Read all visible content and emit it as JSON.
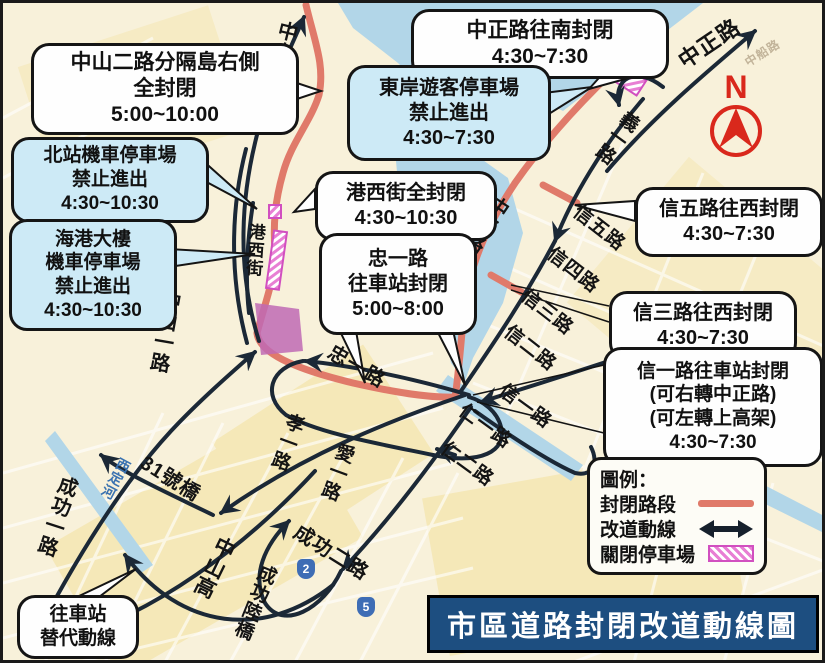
{
  "title_banner": "市區道路封閉改道動線圖",
  "compass": {
    "label": "N"
  },
  "legend": {
    "title": "圖例：",
    "items": [
      {
        "label": "封閉路段",
        "symbol": "closed-road-line"
      },
      {
        "label": "改道動線",
        "symbol": "detour-double-arrow"
      },
      {
        "label": "關閉停車場",
        "symbol": "closed-parking-hatch"
      }
    ]
  },
  "callouts": [
    {
      "id": "zhongshan2-closure",
      "style": "white",
      "lines": [
        "中山二路分隔島右側",
        "全封閉",
        "5:00~10:00"
      ]
    },
    {
      "id": "north-station-parking",
      "style": "blue",
      "lines": [
        "北站機車停車場",
        "禁止進出",
        "4:30~10:30"
      ]
    },
    {
      "id": "harbor-building-parking",
      "style": "blue",
      "lines": [
        "海港大樓",
        "機車停車場",
        "禁止進出",
        "4:30~10:30"
      ]
    },
    {
      "id": "zhongzheng-south-closure",
      "style": "white",
      "lines": [
        "中正路往南封閉",
        "4:30~7:30"
      ]
    },
    {
      "id": "east-coast-parking",
      "style": "blue",
      "lines": [
        "東岸遊客停車場",
        "禁止進出",
        "4:30~7:30"
      ]
    },
    {
      "id": "gangxi-closure",
      "style": "white",
      "lines": [
        "港西街全封閉",
        "4:30~10:30"
      ]
    },
    {
      "id": "zhongyi-closure",
      "style": "white",
      "lines": [
        "忠一路",
        "往車站封閉",
        "5:00~8:00"
      ]
    },
    {
      "id": "xin5-closure",
      "style": "white",
      "lines": [
        "信五路往西封閉",
        "4:30~7:30"
      ]
    },
    {
      "id": "xin3-closure",
      "style": "white",
      "lines": [
        "信三路往西封閉",
        "4:30~7:30"
      ]
    },
    {
      "id": "xin1-closure",
      "style": "white",
      "lines": [
        "信一路往車站封閉",
        "(可右轉中正路)",
        "(可左轉上高架)",
        "4:30~7:30"
      ]
    },
    {
      "id": "alt-route-station",
      "style": "white",
      "lines": [
        "往車站",
        "替代動線"
      ]
    }
  ],
  "roads": {
    "zhongshan1_top": "中山一路",
    "zhongzheng_top": "中正路",
    "yi1": "義一路",
    "zhongzheng_mid": "中正路",
    "gangxi_st": "港西街",
    "xin5": "信五路",
    "xin4": "信四路",
    "xin3": "信三路",
    "xin2": "信二路",
    "xin1": "信一路",
    "ren1": "仁一路",
    "ren2": "仁二路",
    "zhong1": "忠一路",
    "xiao1": "孝一路",
    "ai1": "愛一路",
    "zhongshan1_left": "中山一路",
    "bridge31": "31號橋",
    "chenggong1": "成功一路",
    "xiding_river": "西定河",
    "zhongshan_hwy": "中山高",
    "chenggong2": "成功二路",
    "chenggong_bridge": "成功陸橋",
    "zhongchuan_rd": "中船路"
  },
  "shields": [
    {
      "label": "5"
    },
    {
      "label": "2"
    },
    {
      "label": "5"
    }
  ],
  "colors": {
    "closed_road": "#e07a6a",
    "detour_arrow": "#1b2836",
    "water": "#b2d6e8",
    "parking_hatch": "#d14fc0",
    "callout_blue": "#cdeaf6",
    "banner_bg": "#1d4e80",
    "compass_red": "#d9281c",
    "background": "#f8f1da"
  }
}
